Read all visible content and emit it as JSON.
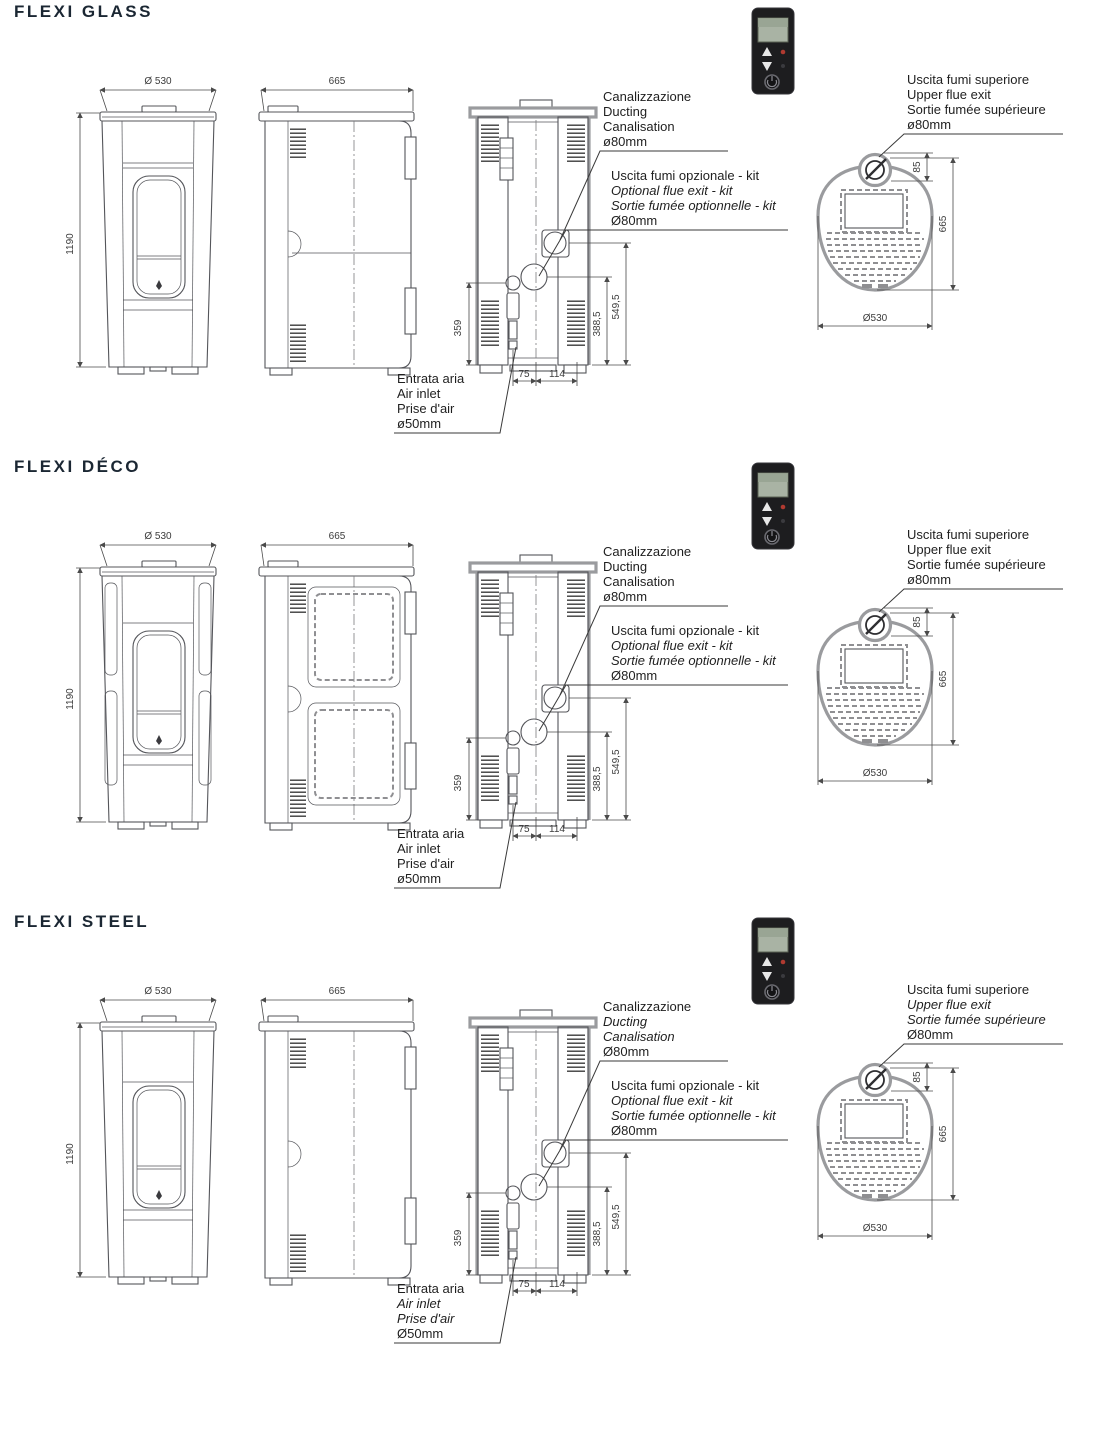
{
  "page": {
    "background": "#ffffff",
    "title_color": "#1b2733",
    "line_color": "#54555a",
    "thick_line_color": "#9a9b9e",
    "remote": {
      "body_color": "#1d1d1f",
      "screen_color": "#a9b3a4",
      "power_button": "power-button",
      "up_button": "up-arrow-button",
      "down_button": "down-arrow-button"
    }
  },
  "sections": [
    {
      "id": "flexi-glass",
      "variant": "glass",
      "title": "FLEXI GLASS",
      "front": {
        "width": "Ø 530",
        "height": "1190"
      },
      "side": {
        "depth": "665"
      },
      "back": {
        "left_height": "359",
        "bottom_left": "75",
        "bottom_right": "114",
        "mid_height": "388,5",
        "upper_height": "549,5"
      },
      "top": {
        "flue_offset": "85",
        "depth": "665",
        "width": "Ø530"
      },
      "annotations": {
        "ducting": {
          "lines": [
            "Canalizzazione",
            "Ducting",
            "Canalisation",
            "ø80mm"
          ]
        },
        "optional_flue": {
          "lines": [
            "Uscita fumi opzionale - kit",
            "Optional flue exit - kit",
            "Sortie fumée optionnelle - kit",
            "Ø80mm"
          ]
        },
        "air_inlet": {
          "lines": [
            "Entrata aria",
            "Air inlet",
            "Prise d'air",
            "ø50mm"
          ]
        },
        "upper_flue": {
          "lines": [
            "Uscita fumi superiore",
            "Upper flue exit",
            "Sortie fumée supérieure",
            "ø80mm"
          ]
        }
      }
    },
    {
      "id": "flexi-deco",
      "variant": "deco",
      "title": "FLEXI DÉCO",
      "front": {
        "width": "Ø 530",
        "height": "1190"
      },
      "side": {
        "depth": "665"
      },
      "back": {
        "left_height": "359",
        "bottom_left": "75",
        "bottom_right": "114",
        "mid_height": "388,5",
        "upper_height": "549,5"
      },
      "top": {
        "flue_offset": "85",
        "depth": "665",
        "width": "Ø530"
      },
      "annotations": {
        "ducting": {
          "lines": [
            "Canalizzazione",
            "Ducting",
            "Canalisation",
            "ø80mm"
          ]
        },
        "optional_flue": {
          "lines": [
            "Uscita fumi opzionale - kit",
            "Optional flue exit - kit",
            "Sortie fumée optionnelle - kit",
            "Ø80mm"
          ]
        },
        "air_inlet": {
          "lines": [
            "Entrata aria",
            "Air inlet",
            "Prise d'air",
            "ø50mm"
          ]
        },
        "upper_flue": {
          "lines": [
            "Uscita fumi superiore",
            "Upper flue exit",
            "Sortie fumée supérieure",
            "ø80mm"
          ]
        }
      }
    },
    {
      "id": "flexi-steel",
      "variant": "steel",
      "title": "FLEXI STEEL",
      "front": {
        "width": "Ø 530",
        "height": "1190"
      },
      "side": {
        "depth": "665"
      },
      "back": {
        "left_height": "359",
        "bottom_left": "75",
        "bottom_right": "114",
        "mid_height": "388,5",
        "upper_height": "549,5"
      },
      "top": {
        "flue_offset": "85",
        "depth": "665",
        "width": "Ø530"
      },
      "annotations": {
        "ducting": {
          "lines": [
            "Canalizzazione",
            "Ducting",
            "Canalisation",
            "Ø80mm"
          ]
        },
        "optional_flue": {
          "lines": [
            "Uscita fumi opzionale - kit",
            "Optional flue exit - kit",
            "Sortie fumée optionnelle - kit",
            "Ø80mm"
          ]
        },
        "air_inlet": {
          "lines": [
            "Entrata aria",
            "Air inlet",
            "Prise d'air",
            "Ø50mm"
          ]
        },
        "upper_flue": {
          "lines": [
            "Uscita fumi superiore",
            "Upper flue exit",
            "Sortie fumée supérieure",
            "Ø80mm"
          ]
        }
      }
    }
  ]
}
